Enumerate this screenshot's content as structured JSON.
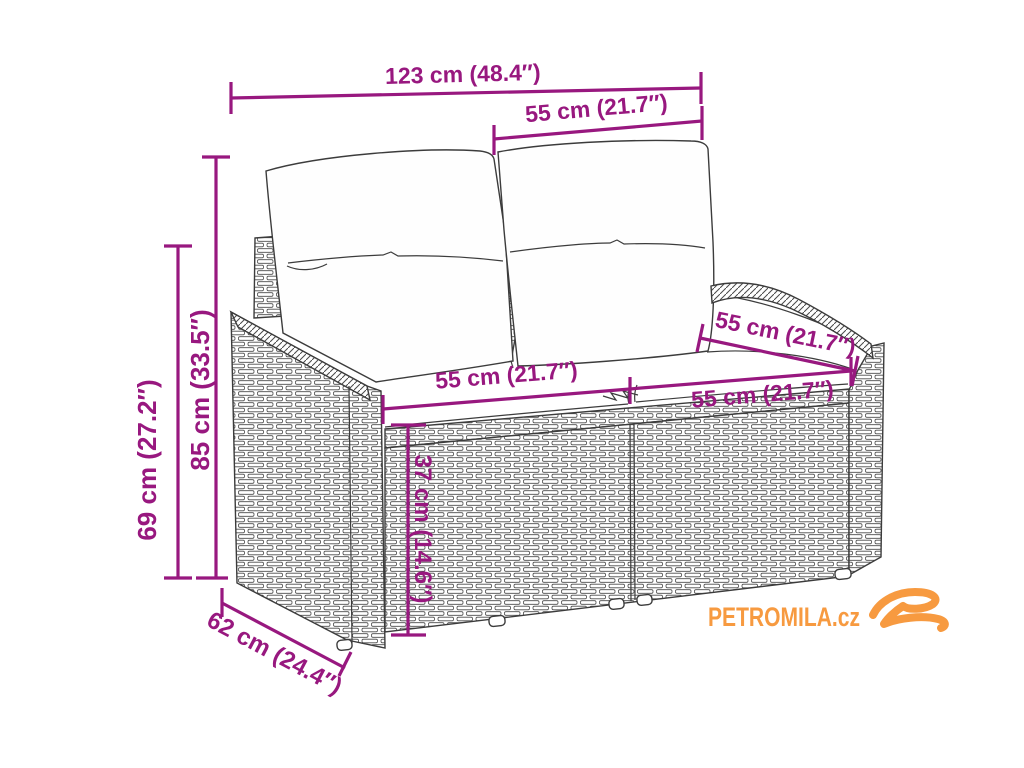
{
  "page": {
    "width": 1024,
    "height": 768,
    "background": "#ffffff"
  },
  "drawing": {
    "subject": "2-seater poly rattan garden bench with back cushions",
    "style": "black line-art product dimension diagram",
    "line_color": "#3c3c3c"
  },
  "dimensions": {
    "color": "#98187F",
    "width_total": "123 cm (48.4″)",
    "back_cushion_width": "55 cm (21.7″)",
    "height_total": "85 cm (33.5″)",
    "height_back": "69 cm (27.2″)",
    "seat_width_left": "55 cm (21.7″)",
    "seat_width_right": "55 cm (21.7″)",
    "seat_depth": "55 cm (21.7″)",
    "seat_height": "37 cm (14.6″)",
    "depth_total": "62 cm (24.4″)"
  },
  "watermark": {
    "text": "PETROMILA.cz",
    "color": "#F79A40",
    "logo": "brush-swirl-icon"
  }
}
